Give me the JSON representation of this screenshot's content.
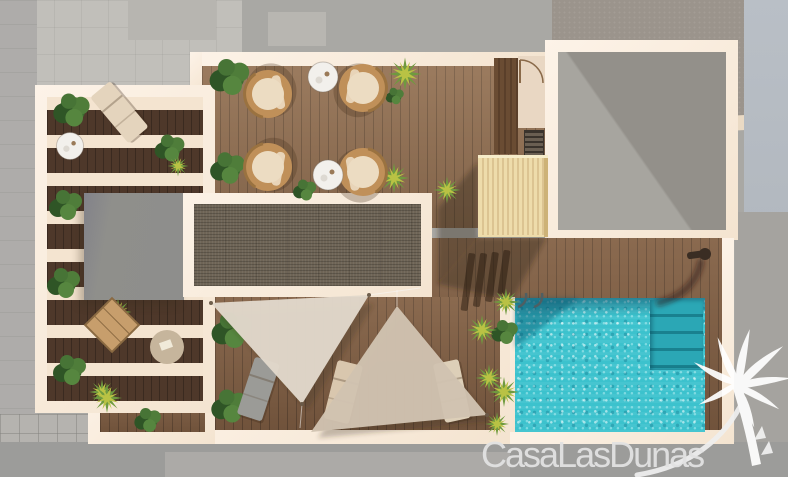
{
  "scene": {
    "type": "architectural-render-top-view",
    "subject": "Top-down 3D render of a rooftop terrace floor plan with pergola, lounge furniture, shade sails and swimming pool, surrounded by gray neighbouring roofs and street",
    "watermark": {
      "brand": "CasaLasDunas",
      "logo": "palm-tree-with-swoosh"
    },
    "objects": [
      "pergola-terrace",
      "wicker-chairs",
      "coffee-tables",
      "lounger",
      "skylight-panel",
      "lower-roof",
      "stair-enclosure",
      "door-room",
      "shade-sails",
      "sun-loungers",
      "swimming-pool",
      "pool-ladder",
      "pool-steps",
      "outdoor-shower",
      "planters",
      "palm-plants",
      "bushes"
    ]
  },
  "colors": {
    "bg": "#a9a8a4",
    "bg_light": "#c1bfba",
    "bg_rough": "#9b948c",
    "bg_blue": "#b2b8bf",
    "parapet": "#eadac4",
    "street": "#9c9c9a",
    "sidewalk": "#b5b3af",
    "pavement": "#a5a39f",
    "wall": "#f4e4d0",
    "wood_terrace": "#8d6c50",
    "wood_deck": "#7d5c42",
    "wood_dark": "#4e382a",
    "panel": "#6e6456",
    "graybox": "#8e8e8c",
    "room": "#e9d7c3",
    "pool": "#3cc2cd",
    "pool_steps": "#2ba7b5",
    "sail": "#d9cdbb",
    "stairbox": "#eedcab",
    "rattan": "#c09059",
    "cushion": "#ecdcc2",
    "table": "#f2f0ec",
    "lounger_gray": "#9b9b97",
    "lounger_beige": "#d9c7ae",
    "bush_dark": "#3c6a2f",
    "bush_mid": "#4f7d3a",
    "palm_yellow": "#b9c244",
    "palm_green": "#6f9a3f",
    "watermark": "#e2e2e2"
  }
}
